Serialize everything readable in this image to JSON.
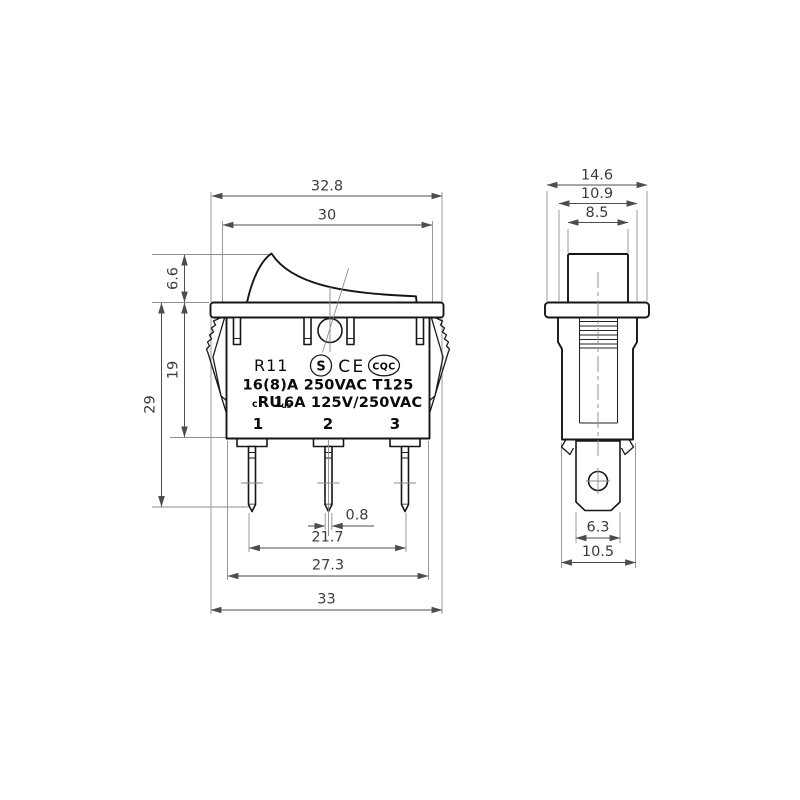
{
  "colors": {
    "background": "#ffffff",
    "part_line": "#161616",
    "dimension_line": "#4d4d4d",
    "extension_line": "#8e8e8e",
    "dimension_text": "#3c3c3c"
  },
  "front_view": {
    "dimensions": {
      "top_overall": "32.8",
      "rocker_opening": "30",
      "rocker_height": "6.6",
      "body_height": "19",
      "overall_height": "29",
      "pin_thickness": "0.8",
      "pin_pitch_outer": "21.7",
      "body_width": "27.3",
      "flange_width": "33"
    },
    "markings": {
      "model": "R11",
      "cert_s": "S",
      "cert_ce": "CE",
      "cert_cqc": "CQC",
      "rating_primary": "16(8)A 250VAC T125",
      "ul_c": "c",
      "ul_ru": "RU",
      "ul_us": "us",
      "rating_secondary": "16A 125V/250VAC",
      "terminals": [
        "1",
        "2",
        "3"
      ]
    }
  },
  "side_view": {
    "dimensions": {
      "flange_depth": "14.6",
      "body_depth": "10.9",
      "rocker_depth": "8.5",
      "terminal_blade_width": "6.3",
      "housing_depth": "10.5"
    }
  }
}
